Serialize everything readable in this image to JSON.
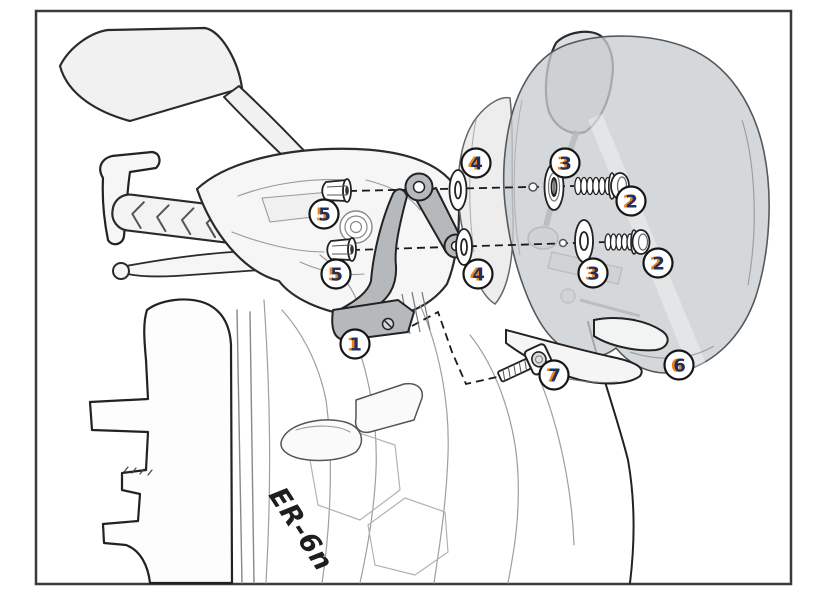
{
  "diagram": {
    "bike_logo": "ER-6n",
    "callouts": [
      "1",
      "2",
      "2",
      "3",
      "3",
      "4",
      "4",
      "5",
      "5",
      "6",
      "7"
    ],
    "palette": {
      "frame_border": "#3a3a3a",
      "line": "#2b2b2b",
      "body_fill": "#f5f5f5",
      "windscreen_fill": "#c9cdcf",
      "bracket_fill": "#b6b9bb",
      "callout_number": "#1d3160",
      "callout_accent": "#f08019"
    }
  }
}
